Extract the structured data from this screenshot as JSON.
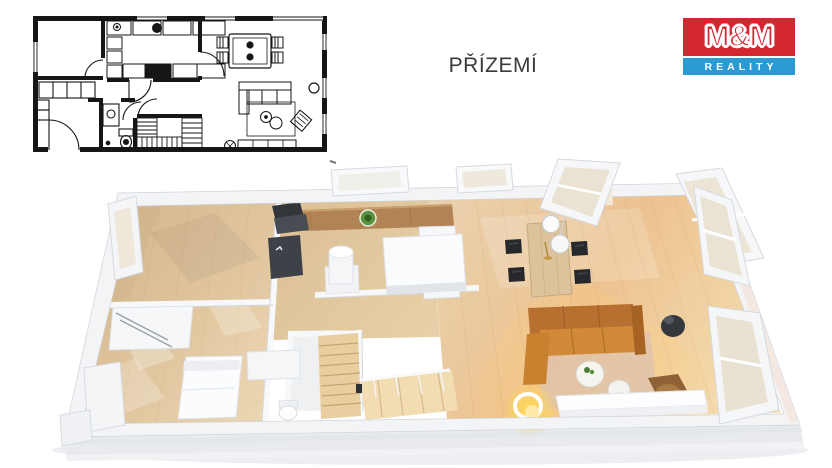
{
  "page": {
    "background_color": "#ffffff"
  },
  "header": {
    "title": "PŘÍZEMÍ",
    "color": "#3a3a3a"
  },
  "logo": {
    "top_text": "M&M",
    "bottom_text": "REALITY",
    "red": "#d42630",
    "blue": "#2a9ad2",
    "text_color": "#ffffff"
  },
  "floorplan_2d": {
    "ink": "#161616",
    "paper": "#ffffff"
  },
  "floorplan_3d": {
    "wall": "#f3f4f6",
    "wall_edge": "#cfd3da",
    "floor_light_wood": "#dfc29c",
    "floor_warm_wood": "#eccb97",
    "sofa_orange": "#c9812f",
    "counter_wood": "#b28355",
    "stairs_wood": "#e9cfa0",
    "glass_tint": "#eae3d3",
    "dark_accent": "#34373c",
    "lamp_glow": "#ffce7a",
    "rug": "#dcc2b2",
    "plant_green": "#5a9440"
  }
}
